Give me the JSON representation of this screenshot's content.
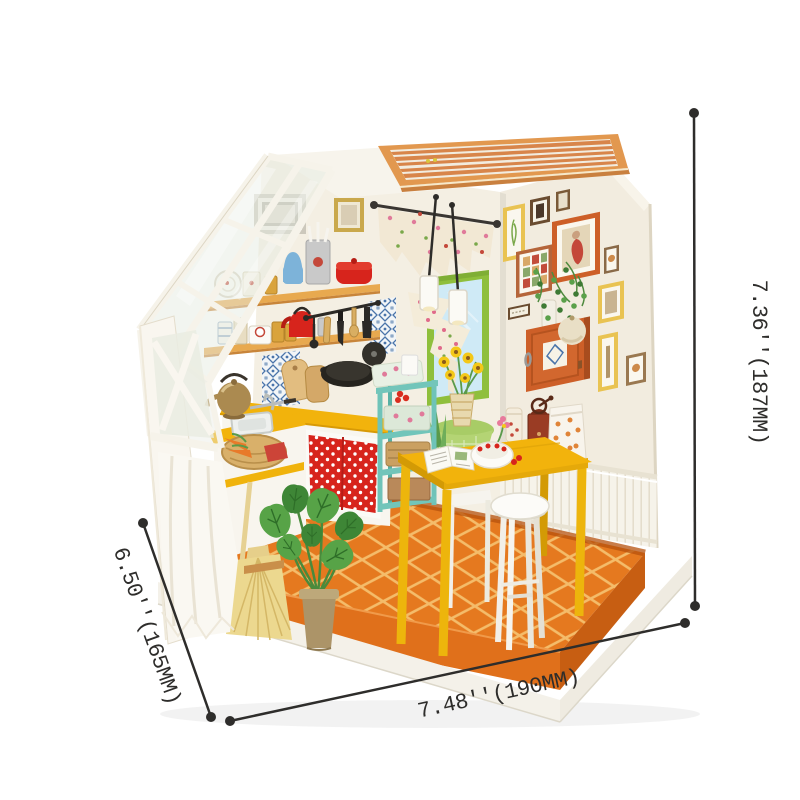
{
  "annotation": {
    "height_label": "7.36''(187MM)",
    "width_label": "7.48''(190MM)",
    "depth_label": "6.50''(165MM)"
  },
  "palette": {
    "line_color": "#2e2d2b",
    "wall_cream": "#f2ecdf",
    "wood_slat": "#e2984f",
    "floor_orange": "#e5791f",
    "table_yellow": "#f2b30c",
    "teal": "#72c5ba",
    "curtain_red": "#d7241c",
    "window_green": "#8fbf3c",
    "cabinet_orange": "#cd5f28"
  }
}
